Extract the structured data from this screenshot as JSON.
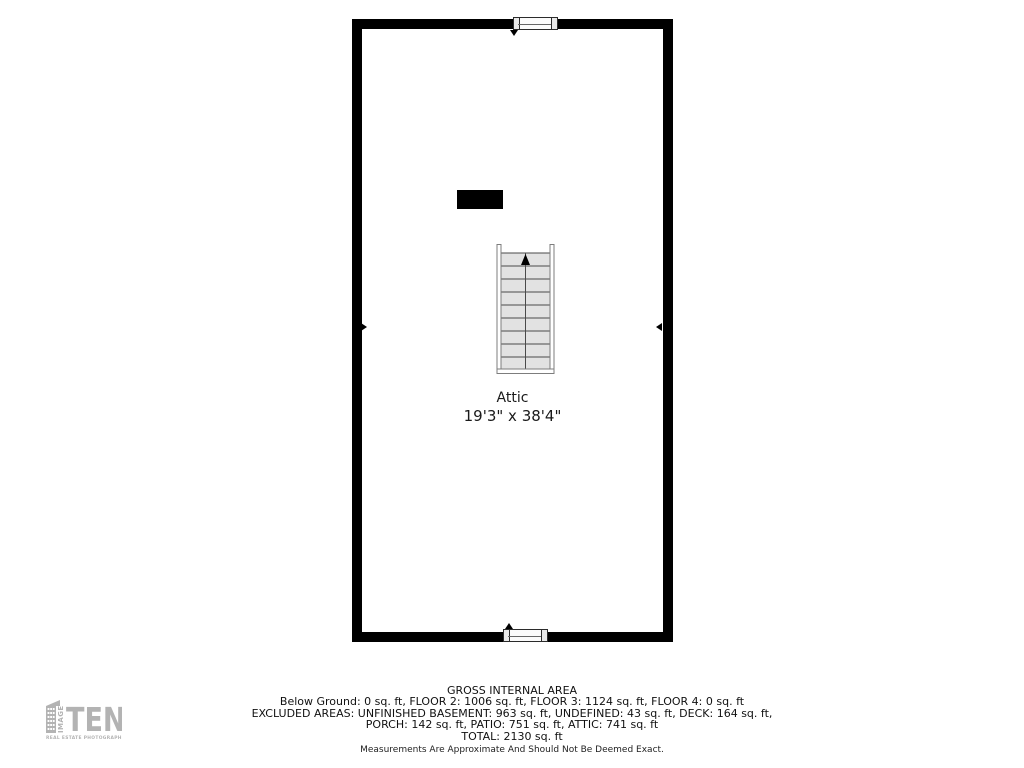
{
  "plan": {
    "room_name": "Attic",
    "room_dimensions": "19'3\" x 38'4\"",
    "stairs": {
      "steps": 9,
      "direction_icon": "up-arrow"
    }
  },
  "footer": {
    "title": "GROSS INTERNAL AREA",
    "lines": [
      "Below Ground: 0 sq. ft, FLOOR 2: 1006 sq. ft, FLOOR 3: 1124 sq. ft, FLOOR 4: 0 sq. ft",
      "EXCLUDED AREAS: UNFINISHED BASEMENT: 963 sq. ft, UNDEFINED: 43 sq. ft, DECK: 164 sq. ft,",
      "PORCH: 142 sq. ft, PATIO: 751 sq. ft, ATTIC: 741 sq. ft",
      "TOTAL: 2130 sq. ft"
    ],
    "disclaimer": "Measurements Are Approximate And Should Not Be Deemed Exact."
  },
  "logo": {
    "vertical_text": "IMAGE",
    "name": "TEN",
    "tagline": "REAL ESTATE PHOTOGRAPHERS"
  },
  "colors": {
    "wall": "#000000",
    "stair_fill": "#e2e2e2",
    "stair_line": "#4a4a4a",
    "logo_gray": "#b3b3b3"
  }
}
